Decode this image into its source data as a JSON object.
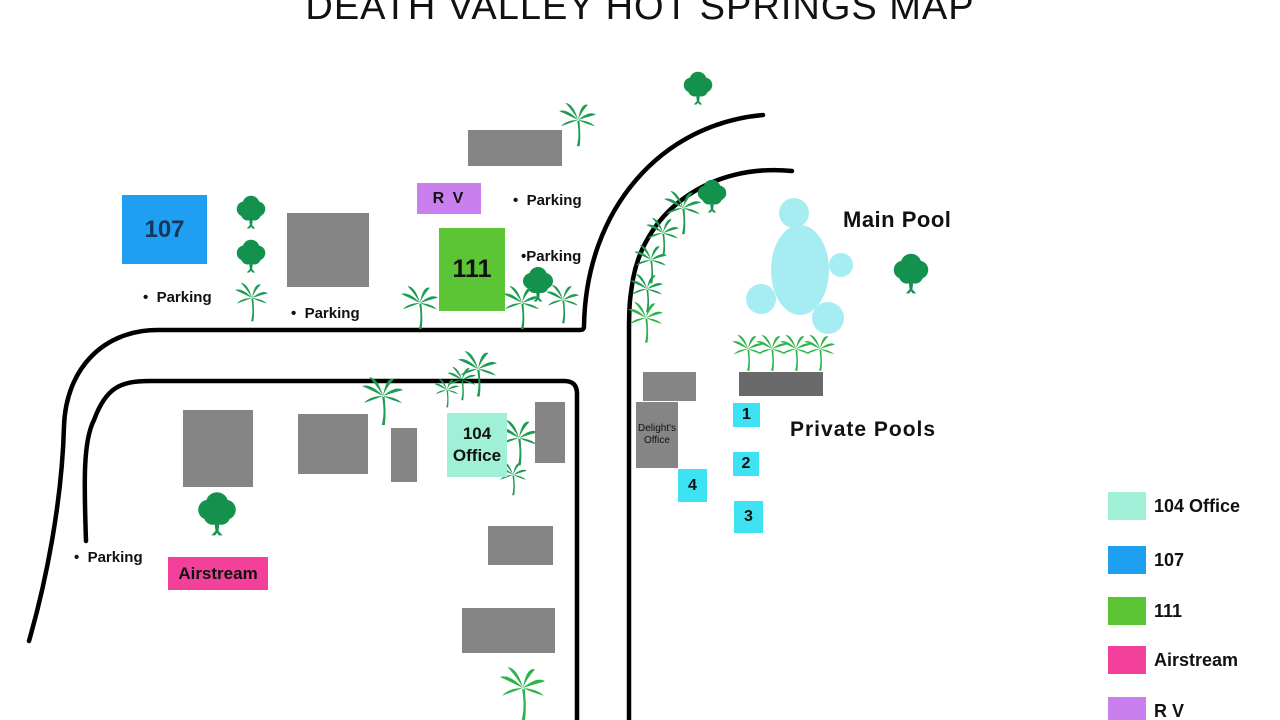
{
  "title": "DEATH VALLEY HOT SPRINGS MAP",
  "colors": {
    "road": "#000000",
    "building_gray": "#858585",
    "dark_gray": "#6A6A6A",
    "tree_green": "#14914C",
    "palm_green": "#1E9C52",
    "palm_bright": "#2CB34A",
    "pool_blue": "#A5EDF2",
    "cyan": "#3FE2F2",
    "blue_107": "#1E9FF2",
    "green_111": "#5BC535",
    "purple_rv": "#C980EE",
    "mint_104": "#9FF0D6",
    "pink_airstream": "#F2409B",
    "navy_text": "#17365C"
  },
  "buildings": {
    "room107": {
      "label": "107"
    },
    "rv": {
      "label": "R V"
    },
    "room111": {
      "label": "111"
    },
    "office104": {
      "label": "104\nOffice"
    },
    "airstream": {
      "label": "Airstream"
    },
    "delights_office": {
      "label": "Delight's\nOffice"
    }
  },
  "pools": {
    "main_label": "Main Pool",
    "private_label": "Private Pools",
    "private_pools": [
      {
        "num": "1"
      },
      {
        "num": "2"
      },
      {
        "num": "4"
      },
      {
        "num": "3"
      }
    ]
  },
  "parking": [
    {
      "text": "•  Parking"
    },
    {
      "text": "•  Parking"
    },
    {
      "text": "•  Parking"
    },
    {
      "text": "•Parking"
    },
    {
      "text": "•  Parking"
    }
  ],
  "legend": {
    "items": [
      {
        "label": "104 Office",
        "color": "#9FF0D6"
      },
      {
        "label": "107",
        "color": "#1E9FF2"
      },
      {
        "label": "111",
        "color": "#5BC535"
      },
      {
        "label": "Airstream",
        "color": "#F2409B"
      },
      {
        "label": "R V",
        "color": "#C980EE"
      }
    ]
  }
}
